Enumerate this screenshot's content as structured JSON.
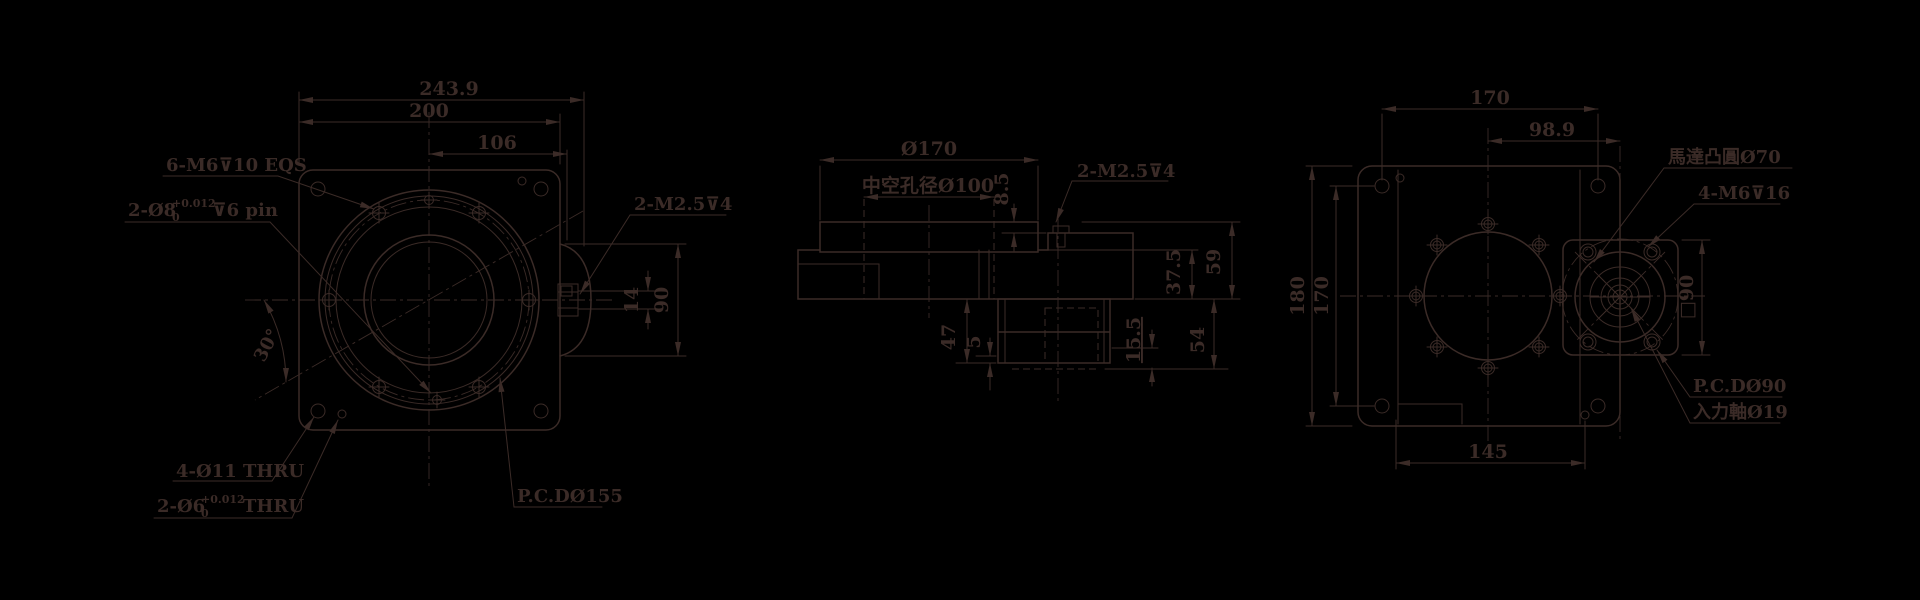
{
  "colors": {
    "background": "#000000",
    "line": "#3b2b27"
  },
  "front": {
    "dim_total_width": "243.9",
    "dim_flange_width": "200",
    "dim_center_to_edge": "106",
    "dim_keyway_height": "14",
    "dim_shaft_boss_height": "90",
    "dim_pin_angle": "30°",
    "label_tap_holes": "6-M6⊽10 EQS",
    "pin8": {
      "prefix": "2-Ø8",
      "tol_upper": "+0.012",
      "tol_lower": "0",
      "suffix": "⊽6 pin"
    },
    "label_thru_holes": "4-Ø11 THRU",
    "pin6": {
      "prefix": "2-Ø6",
      "tol_upper": "+0.012",
      "tol_lower": "0",
      "suffix": "THRU"
    },
    "label_pcd": "P.C.DØ155",
    "label_set_screws": "2-M2.5⊽4"
  },
  "side": {
    "dim_outer_dia": "Ø170",
    "label_bore": "中空孔径Ø100",
    "dim_table_step": "8.5",
    "label_set_screws": "2-M2.5⊽4",
    "dim_total_height": "59",
    "dim_body_height": "37.5",
    "dim_motor_section": "54",
    "dim_motor_inset": "15.5",
    "dim_gear_height": "47",
    "dim_base_plate": "5"
  },
  "rear": {
    "dim_width": "170",
    "dim_axis_distance": "98.9",
    "dim_height": "180",
    "dim_hole_spacing_vertical": "170",
    "dim_hole_spacing_bottom": "145",
    "dim_motor_square": "□90",
    "label_motor_boss": "馬達凸圓Ø70",
    "label_motor_screws": "4-M6⊽16",
    "label_pcd": "P.C.DØ90",
    "label_input_shaft": "入力軸Ø19"
  }
}
